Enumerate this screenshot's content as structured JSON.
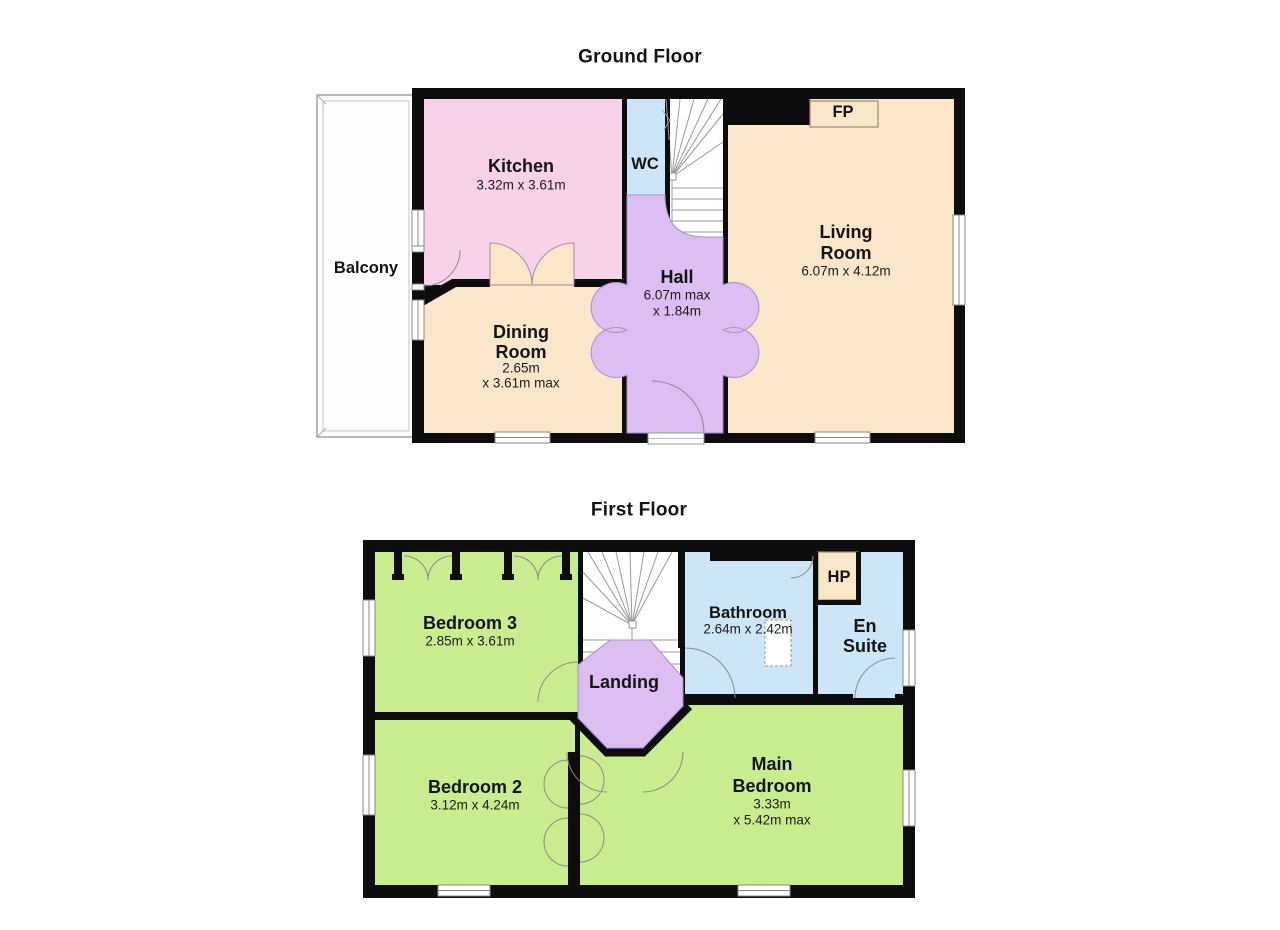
{
  "ground_floor": {
    "title": "Ground Floor",
    "rooms": {
      "balcony": {
        "name": "Balcony"
      },
      "kitchen": {
        "name": "Kitchen",
        "dims": "3.32m x 3.61m"
      },
      "wc": {
        "name": "WC"
      },
      "fireplace": {
        "label": "FP"
      },
      "living_room": {
        "name_line1": "Living",
        "name_line2": "Room",
        "dims": "6.07m x 4.12m"
      },
      "hall": {
        "name": "Hall",
        "dims_line1": "6.07m max",
        "dims_line2": "x 1.84m"
      },
      "dining_room": {
        "name_line1": "Dining",
        "name_line2": "Room",
        "dims_line1": "2.65m",
        "dims_line2": "x 3.61m max"
      }
    }
  },
  "first_floor": {
    "title": "First Floor",
    "rooms": {
      "bedroom3": {
        "name": "Bedroom 3",
        "dims": "2.85m x 3.61m"
      },
      "bathroom": {
        "name": "Bathroom",
        "dims": "2.64m x 2.42m"
      },
      "heating_cupboard": {
        "label": "HP"
      },
      "en_suite": {
        "name_line1": "En",
        "name_line2": "Suite"
      },
      "landing": {
        "name": "Landing"
      },
      "bedroom2": {
        "name": "Bedroom 2",
        "dims": "3.12m x 4.24m"
      },
      "main_bedroom": {
        "name_line1": "Main",
        "name_line2": "Bedroom",
        "dims_line1": "3.33m",
        "dims_line2": "x 5.42m max"
      }
    }
  },
  "colors": {
    "kitchen_pink": "#F8D2E8",
    "room_tan": "#FAE7C9",
    "hall_purple": "#DCBEF2",
    "wc_blue": "#CDE6F7",
    "bedroom_green": "#C9ED8E",
    "wall_black": "#0D0D0D"
  }
}
